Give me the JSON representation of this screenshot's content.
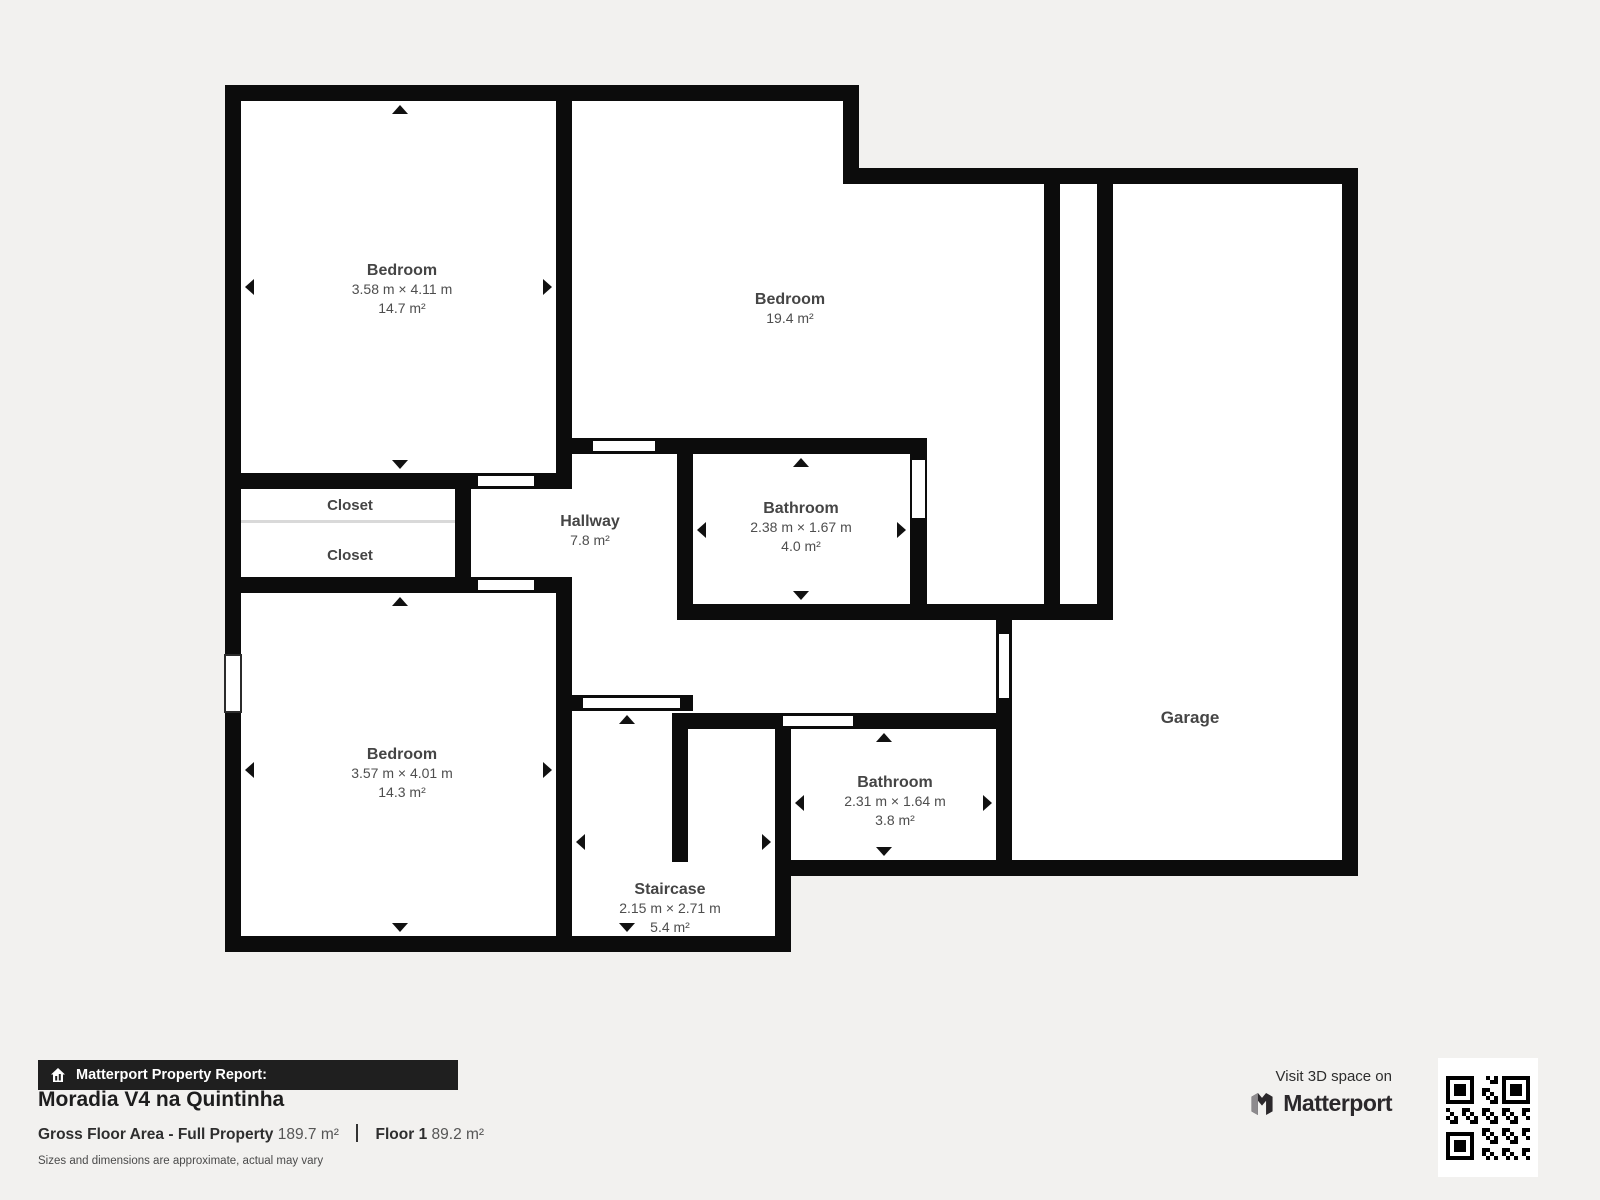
{
  "floorplan": {
    "rooms": [
      {
        "name": "Bedroom",
        "dims": "3.58 m × 4.11 m",
        "area": "14.7 m²"
      },
      {
        "name": "Bedroom",
        "area": "19.4 m²"
      },
      {
        "name": "Closet"
      },
      {
        "name": "Closet"
      },
      {
        "name": "Hallway",
        "area": "7.8 m²"
      },
      {
        "name": "Bathroom",
        "dims": "2.38 m × 1.67 m",
        "area": "4.0 m²"
      },
      {
        "name": "Bedroom",
        "dims": "3.57 m × 4.01 m",
        "area": "14.3 m²"
      },
      {
        "name": "Staircase",
        "dims": "2.15 m × 2.71 m",
        "area": "5.4 m²"
      },
      {
        "name": "Bathroom",
        "dims": "2.31 m × 1.64 m",
        "area": "3.8 m²"
      },
      {
        "name": "Garage"
      }
    ]
  },
  "footer": {
    "report_label": "Matterport Property Report:",
    "property_name": "Moradia V4 na Quintinha",
    "gross_label": "Gross Floor Area - Full Property",
    "gross_value": "189.7 m²",
    "floor_label": "Floor 1",
    "floor_value": "89.2 m²",
    "disclaimer": "Sizes and dimensions are approximate, actual may vary"
  },
  "promo": {
    "visit": "Visit 3D space on",
    "brand": "Matterport"
  },
  "colors": {
    "wall": "#0c0c0c",
    "floor": "#ffffff",
    "background": "#f2f1ef",
    "banner": "#1f1f1f",
    "label_text": "#4e4e4e"
  }
}
